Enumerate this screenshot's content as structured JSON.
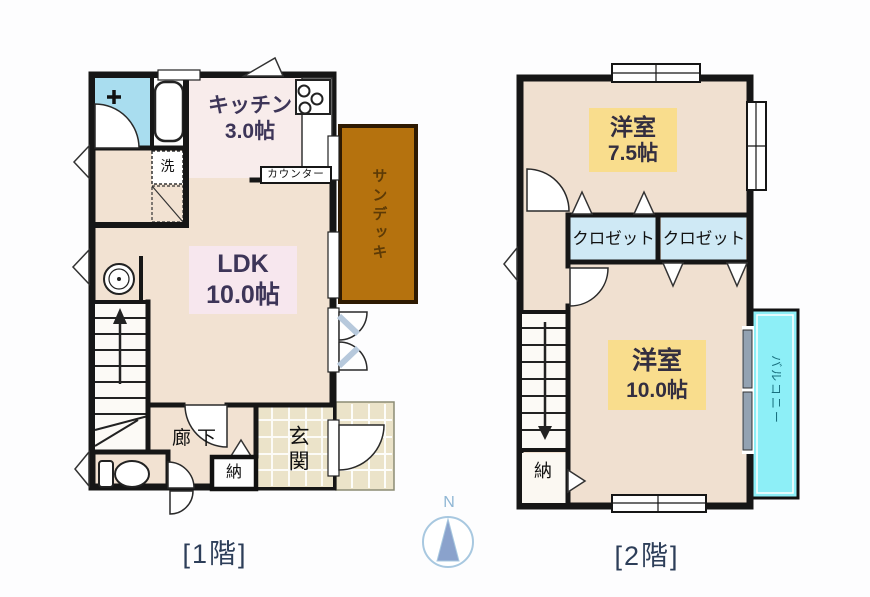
{
  "floor1": {
    "caption": "[1階]",
    "rooms": {
      "kitchen": {
        "name": "キッチン",
        "size": "3.0帖"
      },
      "ldk": {
        "name": "LDK",
        "size": "10.0帖"
      },
      "hallway": "廊下",
      "entrance": "玄関",
      "storage": "納",
      "washer": "洗",
      "counter": "カウンター",
      "sundeck": "サンデッキ"
    }
  },
  "floor2": {
    "caption": "[2階]",
    "rooms": {
      "bedroom_a": {
        "name": "洋室",
        "size": "7.5帖"
      },
      "bedroom_b": {
        "name": "洋室",
        "size": "10.0帖"
      },
      "closet_left": "クロゼット",
      "closet_right": "クロゼット",
      "storage": "納",
      "balcony": "バルコニー"
    }
  },
  "compass": {
    "label": "N"
  },
  "colors": {
    "wall": "#161616",
    "floor_beige": "#f2e2d2",
    "kitchen_floor": "#f8eceb",
    "bathroom_blue": "#a9ddef",
    "closet_blue": "#cfe9f5",
    "ldk_label_bg": "#f7e7ee",
    "bedroom_label_bg": "#f9dd8d",
    "sundeck_brown": "#b5720e",
    "sundeck_text": "#5c3a06",
    "balcony_cyan": "#8deff7",
    "balcony_text": "#19707f",
    "tile": "#ebe3c9",
    "room_text": "#3d3558",
    "caption_text": "#2d3e59",
    "compass_blue": "#8fb6d4"
  }
}
